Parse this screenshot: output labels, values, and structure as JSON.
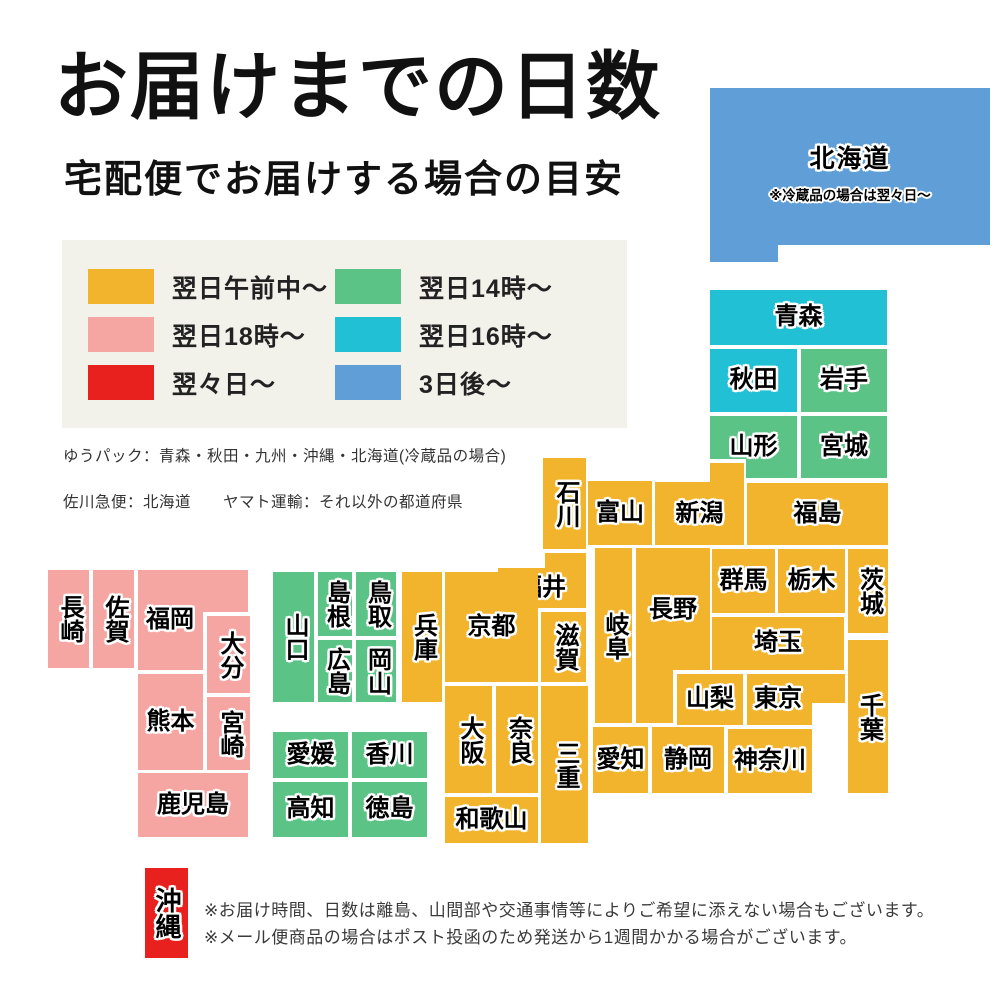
{
  "header": {
    "title": "お届けまでの日数",
    "subtitle": "宅配便でお届けする場合の目安"
  },
  "colors": {
    "yellow": "#f2b42d",
    "green": "#5cc387",
    "teal": "#22c0d4",
    "pink": "#f6a6a2",
    "red": "#e8211f",
    "blue": "#5f9ed6",
    "panel": "#f2f1ea"
  },
  "legend": {
    "items": [
      {
        "label": "翌日午前中〜",
        "color": "yellow"
      },
      {
        "label": "翌日18時〜",
        "color": "pink"
      },
      {
        "label": "翌々日〜",
        "color": "red"
      },
      {
        "label": "翌日14時〜",
        "color": "green"
      },
      {
        "label": "翌日16時〜",
        "color": "teal"
      },
      {
        "label": "3日後〜",
        "color": "blue"
      }
    ]
  },
  "carrier_note": {
    "line1": "ゆうパック：青森・秋田・九州・沖縄・北海道(冷蔵品の場合)",
    "line2": "佐川急便：北海道　　ヤマト運輸：それ以外の都道府県"
  },
  "map": {
    "prefectures": [
      {
        "id": "hokkaido",
        "label": "北海道",
        "note": "※冷蔵品の場合は翌々日〜",
        "color": "blue",
        "rect": [
          710,
          88,
          280,
          174
        ],
        "orient": "h"
      },
      {
        "id": "aomori",
        "label": "青森",
        "color": "teal",
        "rect": [
          710,
          290,
          177,
          55
        ],
        "orient": "h"
      },
      {
        "id": "akita",
        "label": "秋田",
        "color": "teal",
        "rect": [
          710,
          349,
          87,
          63
        ],
        "orient": "h"
      },
      {
        "id": "iwate",
        "label": "岩手",
        "color": "green",
        "rect": [
          801,
          349,
          86,
          63
        ],
        "orient": "h"
      },
      {
        "id": "yamagata",
        "label": "山形",
        "color": "green",
        "rect": [
          710,
          416,
          87,
          62
        ],
        "orient": "h"
      },
      {
        "id": "miyagi",
        "label": "宮城",
        "color": "green",
        "rect": [
          801,
          416,
          86,
          62
        ],
        "orient": "h"
      },
      {
        "id": "fukushima",
        "label": "福島",
        "color": "yellow",
        "rect": [
          747,
          483,
          141,
          62
        ],
        "orient": "h"
      },
      {
        "id": "niigata",
        "label": "新潟",
        "color": "yellow",
        "rect": [
          655,
          463,
          89,
          82
        ],
        "orient": "h"
      },
      {
        "id": "toyama",
        "label": "富山",
        "color": "yellow",
        "rect": [
          588,
          481,
          64,
          64
        ],
        "orient": "h"
      },
      {
        "id": "ishikawa",
        "label": "石川",
        "color": "yellow",
        "rect": [
          543,
          458,
          43,
          91
        ],
        "orient": "v"
      },
      {
        "id": "fukui",
        "label": "福井",
        "color": "yellow",
        "rect": [
          498,
          553,
          88,
          55
        ],
        "orient": "h"
      },
      {
        "id": "gunma",
        "label": "群馬",
        "color": "yellow",
        "rect": [
          712,
          549,
          63,
          64
        ],
        "orient": "h"
      },
      {
        "id": "tochigi",
        "label": "栃木",
        "color": "yellow",
        "rect": [
          778,
          549,
          67,
          64
        ],
        "orient": "h"
      },
      {
        "id": "ibaraki",
        "label": "茨城",
        "color": "yellow",
        "rect": [
          848,
          549,
          40,
          84
        ],
        "orient": "v"
      },
      {
        "id": "saitama",
        "label": "埼玉",
        "color": "yellow",
        "rect": [
          712,
          617,
          132,
          53
        ],
        "orient": "h"
      },
      {
        "id": "chiba",
        "label": "千葉",
        "color": "yellow",
        "rect": [
          848,
          640,
          40,
          153
        ],
        "orient": "v"
      },
      {
        "id": "yamanashi",
        "label": "山梨",
        "color": "yellow",
        "rect": [
          677,
          674,
          66,
          51
        ],
        "orient": "h"
      },
      {
        "id": "tokyo",
        "label": "東京",
        "color": "yellow",
        "rect": [
          747,
          674,
          98,
          51
        ],
        "orient": "h"
      },
      {
        "id": "kanagawa",
        "label": "神奈川",
        "color": "yellow",
        "rect": [
          728,
          729,
          84,
          64
        ],
        "orient": "h"
      },
      {
        "id": "nagano",
        "label": "長野",
        "color": "yellow",
        "rect": [
          636,
          548,
          74,
          175
        ],
        "orient": "h"
      },
      {
        "id": "gifu",
        "label": "岐阜",
        "color": "yellow",
        "rect": [
          595,
          548,
          37,
          175
        ],
        "orient": "v"
      },
      {
        "id": "shizuoka",
        "label": "静岡",
        "color": "yellow",
        "rect": [
          652,
          727,
          72,
          66
        ],
        "orient": "h"
      },
      {
        "id": "aichi",
        "label": "愛知",
        "color": "yellow",
        "rect": [
          593,
          727,
          55,
          66
        ],
        "orient": "h"
      },
      {
        "id": "kyoto",
        "label": "京都",
        "color": "yellow",
        "rect": [
          445,
          572,
          93,
          110
        ],
        "orient": "h"
      },
      {
        "id": "shiga",
        "label": "滋賀",
        "color": "yellow",
        "rect": [
          541,
          612,
          45,
          70
        ],
        "orient": "v"
      },
      {
        "id": "mie",
        "label": "三重",
        "color": "yellow",
        "rect": [
          541,
          686,
          47,
          157
        ],
        "orient": "v"
      },
      {
        "id": "nara",
        "label": "奈良",
        "color": "yellow",
        "rect": [
          496,
          686,
          42,
          107
        ],
        "orient": "v"
      },
      {
        "id": "osaka",
        "label": "大阪",
        "color": "yellow",
        "rect": [
          445,
          686,
          47,
          107
        ],
        "orient": "v"
      },
      {
        "id": "wakayama",
        "label": "和歌山",
        "color": "yellow",
        "rect": [
          445,
          797,
          93,
          46
        ],
        "orient": "h"
      },
      {
        "id": "hyogo",
        "label": "兵庫",
        "color": "yellow",
        "rect": [
          402,
          572,
          40,
          130
        ],
        "orient": "v"
      },
      {
        "id": "tottori",
        "label": "鳥取",
        "color": "green",
        "rect": [
          356,
          572,
          40,
          64
        ],
        "orient": "v"
      },
      {
        "id": "shimane",
        "label": "島根",
        "color": "green",
        "rect": [
          318,
          572,
          34,
          64
        ],
        "orient": "v"
      },
      {
        "id": "okayama",
        "label": "岡山",
        "color": "green",
        "rect": [
          356,
          640,
          40,
          62
        ],
        "orient": "v"
      },
      {
        "id": "hiroshima",
        "label": "広島",
        "color": "green",
        "rect": [
          318,
          640,
          34,
          62
        ],
        "orient": "v"
      },
      {
        "id": "yamaguchi",
        "label": "山口",
        "color": "green",
        "rect": [
          273,
          572,
          41,
          130
        ],
        "orient": "v"
      },
      {
        "id": "kagawa",
        "label": "香川",
        "color": "green",
        "rect": [
          352,
          732,
          75,
          46
        ],
        "orient": "h"
      },
      {
        "id": "ehime",
        "label": "愛媛",
        "color": "green",
        "rect": [
          273,
          732,
          75,
          46
        ],
        "orient": "h"
      },
      {
        "id": "tokushima",
        "label": "徳島",
        "color": "green",
        "rect": [
          352,
          782,
          75,
          55
        ],
        "orient": "h"
      },
      {
        "id": "kochi",
        "label": "高知",
        "color": "green",
        "rect": [
          273,
          782,
          75,
          55
        ],
        "orient": "h"
      },
      {
        "id": "fukuoka",
        "label": "福岡",
        "color": "pink",
        "rect": [
          138,
          570,
          110,
          100
        ],
        "orient": "h"
      },
      {
        "id": "saga",
        "label": "佐賀",
        "color": "pink",
        "rect": [
          93,
          570,
          41,
          98
        ],
        "orient": "v"
      },
      {
        "id": "nagasaki",
        "label": "長崎",
        "color": "pink",
        "rect": [
          48,
          570,
          41,
          98
        ],
        "orient": "v"
      },
      {
        "id": "oita",
        "label": "大分",
        "color": "pink",
        "rect": [
          207,
          616,
          43,
          77
        ],
        "orient": "v"
      },
      {
        "id": "kumamoto",
        "label": "熊本",
        "color": "pink",
        "rect": [
          138,
          674,
          65,
          96
        ],
        "orient": "h"
      },
      {
        "id": "miyazaki",
        "label": "宮崎",
        "color": "pink",
        "rect": [
          207,
          697,
          43,
          73
        ],
        "orient": "v"
      },
      {
        "id": "kagoshima",
        "label": "鹿児島",
        "color": "pink",
        "rect": [
          138,
          773,
          110,
          64
        ],
        "orient": "h"
      },
      {
        "id": "okinawa",
        "label": "沖縄",
        "color": "red",
        "rect": [
          145,
          868,
          43,
          90
        ],
        "orient": "v"
      }
    ]
  },
  "footer": {
    "note1": "※お届け時間、日数は離島、山間部や交通事情等によりご希望に添えない場合もございます。",
    "note2": "※メール便商品の場合はポスト投函のため発送から1週間かかる場合がございます。"
  }
}
